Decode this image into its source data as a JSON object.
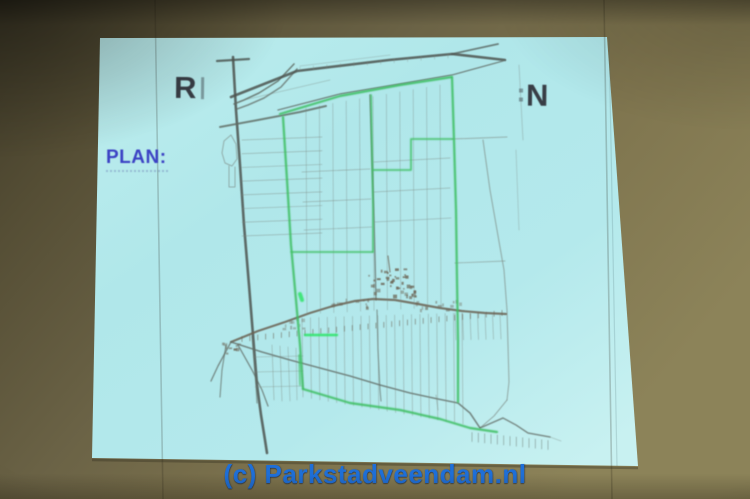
{
  "scene": {
    "description": "Photograph of a presentation slide projected on a wall screen, showing a rural land parcel map with a green route/boundary plan",
    "watermark": "(c) Parkstadveendam.nl"
  },
  "slide": {
    "title_fragment_left": "R",
    "title_fragment_right": "N",
    "plan_label": "PLAN:"
  },
  "colors": {
    "wall_dark": "#3f3a28",
    "wall_light": "#8c8359",
    "screen_cyan": "#b2e8eb",
    "title_text": "#383d45",
    "plan_label_text": "#3c42c4",
    "watermark_blue": "#1e6fd8",
    "map_road_gray": "#5a615c",
    "map_green_route": "#3fbf63"
  },
  "map": {
    "palette": {
      "dark": "#4d544f",
      "road": "#5f6a63",
      "light": "#7b857e",
      "village": "#6b6353",
      "green": "#3fbf63",
      "bgreen": "#2ee468"
    },
    "paths": [
      {
        "c": "dark",
        "w": 2.6,
        "o": 0.85,
        "p": "233,57 236,110 240,165 244,225 249,285 253,335 257,385 261,415 265,440 267,453"
      },
      {
        "c": "dark",
        "w": 2.2,
        "o": 0.8,
        "p": "217,61 249,59"
      },
      {
        "c": "road",
        "w": 1.6,
        "o": 0.8,
        "p": "294,64 278,81 259,93 244,100 234,104"
      },
      {
        "c": "road",
        "w": 1.6,
        "o": 0.7,
        "p": "297,69 281,87 264,98 248,105 237,109"
      },
      {
        "c": "dark",
        "w": 2.6,
        "o": 0.85,
        "p": "231,97 297,71 389,60 452,54 505,60"
      },
      {
        "c": "dark",
        "w": 1.8,
        "o": 0.7,
        "p": "452,54 498,44"
      },
      {
        "c": "road",
        "w": 1.4,
        "o": 0.75,
        "p": "278,110 340,94 400,84 452,75 503,61"
      },
      {
        "c": "road",
        "w": 2.0,
        "o": 0.8,
        "p": "220,127 258,120 300,112 326,106"
      },
      {
        "c": "light",
        "w": 1,
        "o": 0.6,
        "p": "231,135 224,141 222,153 225,163 232,166 237,159 236,144 231,135"
      },
      {
        "c": "light",
        "w": 1,
        "o": 0.6,
        "p": "229,166 229,187 235,187 235,167"
      },
      {
        "c": "road",
        "w": 1.4,
        "o": 0.7,
        "p": "370,95 372,160 374,220 375,258 376,300"
      },
      {
        "c": "road",
        "w": 1.2,
        "o": 0.6,
        "p": "377,310 378,350 380,390 381,401"
      },
      {
        "c": "light",
        "w": 1.1,
        "o": 0.6,
        "p": "483,140 490,190 497,230 504,270 507,310 508,345 509,382 507,400"
      },
      {
        "c": "light",
        "w": 1.1,
        "o": 0.6,
        "p": "507,400 494,416 480,428"
      },
      {
        "c": "light",
        "w": 1,
        "o": 0.55,
        "p": "452,139 507,137"
      },
      {
        "c": "light",
        "w": 0.9,
        "o": 0.5,
        "p": "455,263 505,261"
      },
      {
        "c": "village",
        "w": 2.2,
        "o": 0.85,
        "p": "231,342 258,331 285,322 310,313 333,306 355,301 373,299 395,300 418,304 440,308 462,311 485,313 506,314"
      },
      {
        "c": "road",
        "w": 1.6,
        "o": 0.75,
        "p": "231,342 262,352 290,360 320,368 350,376 380,385 410,393 438,399 458,403 470,413 480,428"
      },
      {
        "c": "road",
        "w": 1.5,
        "o": 0.7,
        "p": "480,428 503,418 516,425 528,433 550,437"
      },
      {
        "c": "road",
        "w": 1.4,
        "o": 0.7,
        "p": "231,342 218,366 211,381"
      },
      {
        "c": "road",
        "w": 1.2,
        "o": 0.65,
        "p": "226,345 222,370 220,397"
      },
      {
        "c": "road",
        "w": 1.3,
        "o": 0.7,
        "p": "238,345 252,370 262,390 268,406"
      },
      {
        "c": "road",
        "w": 1.2,
        "o": 0.6,
        "p": "252,336 254,362 256,386 257,403"
      },
      {
        "c": "light",
        "w": 0.8,
        "o": 0.5,
        "p": "302,172 370,169"
      },
      {
        "c": "light",
        "w": 0.8,
        "o": 0.5,
        "p": "303,202 371,199"
      },
      {
        "c": "light",
        "w": 0.8,
        "o": 0.45,
        "p": "304,230 372,227"
      },
      {
        "c": "light",
        "w": 0.8,
        "o": 0.5,
        "p": "374,162 450,158"
      },
      {
        "c": "light",
        "w": 0.8,
        "o": 0.5,
        "p": "374,192 450,188"
      },
      {
        "c": "light",
        "w": 0.8,
        "o": 0.45,
        "p": "375,222 451,218"
      },
      {
        "c": "light",
        "w": 0.8,
        "o": 0.4,
        "p": "519,65 523,140"
      },
      {
        "c": "light",
        "w": 0.8,
        "o": 0.35,
        "p": "516,150 519,230"
      },
      {
        "c": "light",
        "w": 0.7,
        "o": 0.4,
        "p": "240,101 330,80"
      },
      {
        "c": "light",
        "w": 0.7,
        "o": 0.35,
        "p": "300,66 390,55"
      },
      {
        "c": "village",
        "w": 1.2,
        "o": 0.7,
        "p": "388,256 390,272"
      },
      {
        "c": "light",
        "w": 0.8,
        "o": 0.5,
        "p": "436,395 438,410"
      },
      {
        "c": "light",
        "w": 0.7,
        "o": 0.5,
        "p": "272,345 274,400"
      },
      {
        "c": "light",
        "w": 0.7,
        "o": 0.5,
        "p": "280,346 282,401"
      },
      {
        "c": "light",
        "w": 0.7,
        "o": 0.45,
        "p": "288,347 290,401"
      },
      {
        "c": "light",
        "w": 0.7,
        "o": 0.45,
        "p": "296,348 297,400"
      },
      {
        "c": "light",
        "w": 0.7,
        "o": 0.4,
        "p": "253,357 303,356"
      },
      {
        "c": "light",
        "w": 0.7,
        "o": 0.4,
        "p": "254,372 303,371"
      },
      {
        "c": "light",
        "w": 0.7,
        "o": 0.4,
        "p": "255,387 303,386"
      },
      {
        "c": "light",
        "w": 0.8,
        "o": 0.4,
        "p": "550,437 561,441"
      }
    ],
    "green_paths": [
      {
        "c": "green",
        "w": 2.2,
        "o": 0.9,
        "p": "280,114 340,96 400,85 452,77"
      },
      {
        "c": "green",
        "w": 2.2,
        "o": 0.9,
        "p": "283,117 287,180 291,245 296,300 300,345 303,389"
      },
      {
        "c": "green",
        "w": 2.2,
        "o": 0.9,
        "p": "452,77 454,140 456,210 457,280 458,340 458,402"
      },
      {
        "c": "green",
        "w": 1.8,
        "o": 0.85,
        "p": "371,95 372,150 373,205 373,252"
      },
      {
        "c": "green",
        "w": 1.8,
        "o": 0.85,
        "p": "291,252 373,252"
      },
      {
        "c": "green",
        "w": 1.8,
        "o": 0.85,
        "p": "452,139 411,139 411,170 373,170"
      },
      {
        "c": "bgreen",
        "w": 2.4,
        "o": 0.9,
        "p": "305,335 337,335"
      },
      {
        "c": "green",
        "w": 2.2,
        "o": 0.9,
        "p": "303,389 350,403 400,410 440,419 470,428 497,432"
      },
      {
        "c": "green",
        "w": 1.6,
        "o": 0.7,
        "p": "299,355 300,385"
      },
      {
        "c": "bgreen",
        "w": 4,
        "o": 0.85,
        "p": "300,294 302,300"
      }
    ],
    "vline_groups": [
      {
        "x1": 306,
        "x2": 440,
        "n": 11,
        "yt1": 108,
        "yt2": 85,
        "yb1": 314,
        "yb2": 307,
        "w": 0.7,
        "o": 0.45,
        "c": "light"
      },
      {
        "x1": 302,
        "x2": 462,
        "n": 20,
        "yt1": 318,
        "yt2": 313,
        "yb1": 397,
        "yb2": 424,
        "w": 0.7,
        "o": 0.5,
        "c": "light"
      },
      {
        "x1": 455,
        "x2": 500,
        "n": 7,
        "yt1": 313,
        "yt2": 314,
        "yb1": 340,
        "yb2": 339,
        "w": 0.7,
        "o": 0.5,
        "c": "light"
      }
    ],
    "hline_groups": [
      {
        "y1": 140,
        "y2": 236,
        "n": 8,
        "xl": 242,
        "xr": 322,
        "slant": -3,
        "w": 0.7,
        "o": 0.5,
        "c": "light"
      }
    ],
    "tick_groups": [
      {
        "x1": 242,
        "y1": 339,
        "x2": 502,
        "y2": 313,
        "n": 34,
        "len": 5,
        "off": 0,
        "w": 0.9,
        "o": 0.6,
        "c": "village"
      },
      {
        "x1": 472,
        "y1": 433,
        "x2": 548,
        "y2": 441,
        "n": 13,
        "len": 9,
        "off": 4,
        "w": 0.8,
        "o": 0.5,
        "c": "road"
      },
      {
        "x1": 300,
        "y1": 69,
        "x2": 448,
        "y2": 56,
        "n": 12,
        "len": 4,
        "off": 0,
        "w": 0.7,
        "o": 0.4,
        "c": "light"
      }
    ],
    "clusters": [
      {
        "cx": 389,
        "cy": 280,
        "rx": 22,
        "ry": 12,
        "n": 30,
        "seed": 11,
        "o": 0.85
      },
      {
        "cx": 403,
        "cy": 292,
        "rx": 13,
        "ry": 7,
        "n": 14,
        "seed": 23,
        "o": 0.75
      },
      {
        "cx": 352,
        "cy": 303,
        "rx": 26,
        "ry": 5,
        "n": 12,
        "seed": 5,
        "o": 0.5
      },
      {
        "cx": 435,
        "cy": 305,
        "rx": 28,
        "ry": 5,
        "n": 14,
        "seed": 9,
        "o": 0.5
      },
      {
        "cx": 300,
        "cy": 322,
        "rx": 18,
        "ry": 6,
        "n": 10,
        "seed": 3,
        "o": 0.45
      },
      {
        "cx": 231,
        "cy": 345,
        "rx": 10,
        "ry": 8,
        "n": 10,
        "seed": 17,
        "o": 0.6
      }
    ]
  }
}
